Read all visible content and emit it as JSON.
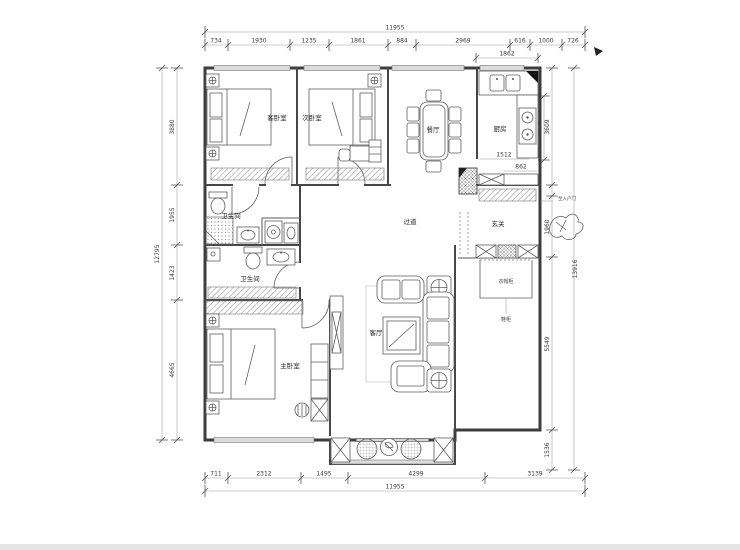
{
  "colors": {
    "wall": "#3d3d3d",
    "dim_line": "#999999",
    "window_fill": "#dcdcdc"
  },
  "rooms": {
    "guest_bedroom": "客卧室",
    "second_bedroom": "次卧室",
    "dining": "餐厅",
    "kitchen": "厨房",
    "bathroom_upper": "卫生间",
    "bathroom_lower": "卫生间",
    "corridor": "过道",
    "entry": "玄关",
    "living": "客厅",
    "master_bedroom": "主卧室"
  },
  "annotations": {
    "coat_cabinet": "衣帽柜",
    "shoe_cabinet": "鞋柜",
    "entry_note": "至入户门"
  },
  "dims": {
    "top": {
      "total": "11955",
      "segments": [
        "734",
        "1930",
        "1235",
        "1861",
        "884",
        "2969",
        "616",
        "1000",
        "726"
      ]
    },
    "bottom": {
      "total": "11955",
      "segments": [
        "711",
        "2312",
        "1495",
        "4299",
        "3139"
      ]
    },
    "left": {
      "total": "12795",
      "segments": [
        "3880",
        "1955",
        "1423",
        "4665"
      ]
    },
    "right": {
      "total": "13916",
      "segments": [
        "3609",
        "1960",
        "5549",
        "1536"
      ]
    },
    "kitchen": {
      "width": "1862",
      "inner": "2476",
      "counter": "1512",
      "lower": "862"
    }
  }
}
